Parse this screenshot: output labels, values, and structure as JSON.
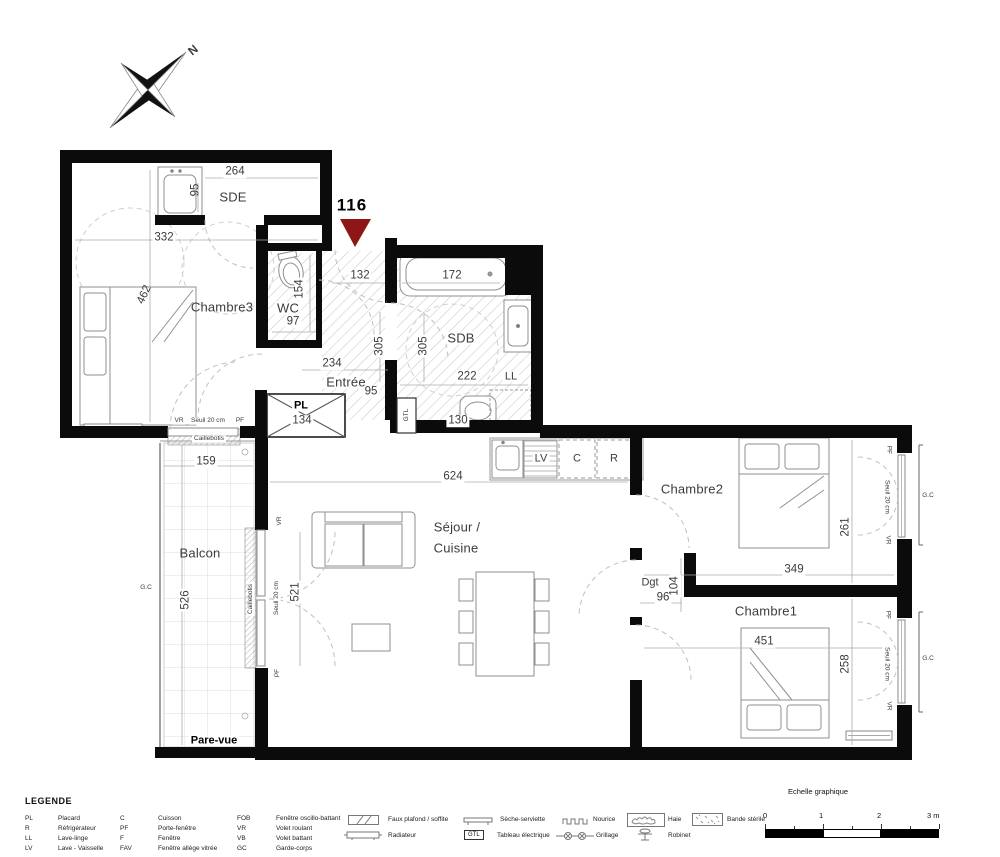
{
  "plan": {
    "north_label": "N",
    "unit_number": "116",
    "rooms": {
      "chambre3": "Chambre3",
      "sde": "SDE",
      "wc": "WC",
      "sdb": "SDB",
      "entree": "Entrée",
      "sejour_line1": "Séjour /",
      "sejour_line2": "Cuisine",
      "chambre2": "Chambre2",
      "chambre1": "Chambre1",
      "balcon": "Balcon",
      "dgt": "Dgt",
      "placard": "PL"
    },
    "equipment": {
      "ll": "LL",
      "lv": "LV",
      "cuisson": "C",
      "refrigerateur": "R",
      "gtl": "GTL"
    },
    "dims": {
      "chambre3_width": "332",
      "chambre3_depth": "462",
      "sde_width": "264",
      "sde_depth": "95",
      "wc_depth": "154",
      "wc_width": "97",
      "entree_top": "132",
      "baignoire": "172",
      "hall_depth": "305",
      "sdb_depth": "305",
      "sdb_width": "222",
      "sdb_bottom": "130",
      "entree_width": "234",
      "entree_depth": "95",
      "placard_width": "134",
      "sejour_width": "624",
      "baie_sejour": "521",
      "balcon_width": "159",
      "balcon_depth": "526",
      "chambre2_depth": "261",
      "chambre2_width": "349",
      "dgt_width": "96",
      "dgt_depth": "104",
      "chambre1_width": "451",
      "chambre1_depth": "258"
    },
    "annotations": {
      "gc": "G.C",
      "caillebotis": "Caillebotis",
      "pare_vue": "Pare-vue",
      "seuil": "Seuil 20 cm",
      "vr": "VR",
      "pf": "PF"
    }
  },
  "legend": {
    "title": "LEGENDE",
    "abbreviations": [
      {
        "abbr": "PL",
        "label": "Placard"
      },
      {
        "abbr": "R",
        "label": "Réfrigérateur"
      },
      {
        "abbr": "LL",
        "label": "Lave-linge"
      },
      {
        "abbr": "LV",
        "label": "Lave - Vaisselle"
      },
      {
        "abbr": "C",
        "label": "Cuisson"
      },
      {
        "abbr": "PF",
        "label": "Porte-fenêtre"
      },
      {
        "abbr": "F",
        "label": "Fenêtre"
      },
      {
        "abbr": "FAV",
        "label": "Fenêtre allège vitrée"
      },
      {
        "abbr": "FOB",
        "label": "Fenêtre oscillo-battant"
      },
      {
        "abbr": "VR",
        "label": "Volet roulant"
      },
      {
        "abbr": "VB",
        "label": "Volet battant"
      },
      {
        "abbr": "GC",
        "label": "Garde-corps"
      }
    ],
    "symbols": [
      {
        "name": "faux-plafond",
        "label": "Faux plafond / soffite"
      },
      {
        "name": "radiateur",
        "label": "Radiateur"
      },
      {
        "name": "seche-serviette",
        "label": "Sèche-serviette"
      },
      {
        "name": "tableau-electrique",
        "abbr": "GTL",
        "label": "Tableau électrique"
      },
      {
        "name": "nourice",
        "label": "Nourice"
      },
      {
        "name": "grillage",
        "label": "Grillage"
      },
      {
        "name": "haie",
        "label": "Haie"
      },
      {
        "name": "robinet",
        "label": "Robinet"
      },
      {
        "name": "bande-sterile",
        "label": "Bande stérile"
      }
    ],
    "scale": {
      "title": "Echelle graphique",
      "ticks": [
        "0",
        "1",
        "2",
        "3 m"
      ]
    }
  },
  "colors": {
    "wall": "#0b0b0b",
    "marker_red": "#8e1616",
    "line_gray": "#ababab"
  }
}
